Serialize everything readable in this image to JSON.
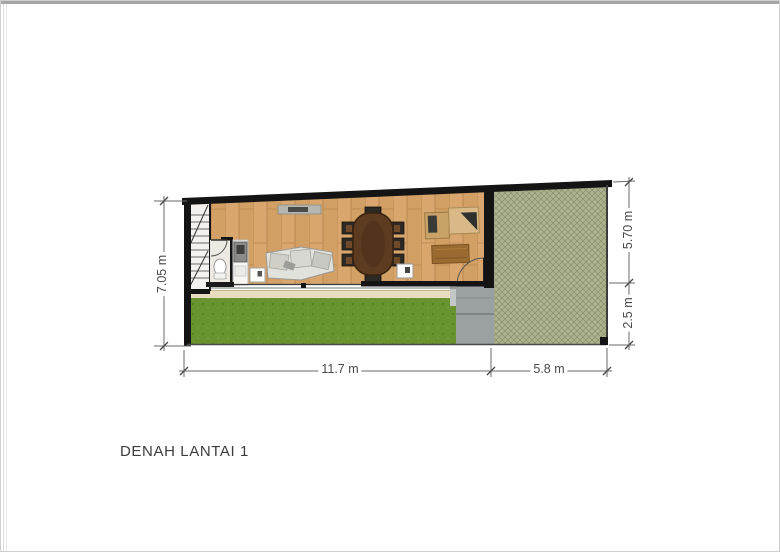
{
  "meta": {
    "title": "DENAH LANTAI 1"
  },
  "dimensions": {
    "left_height": "7.05 m",
    "right_upper": "5.70 m",
    "right_lower": "2.5 m",
    "bottom_main": "11.7 m",
    "bottom_side": "5.8 m"
  },
  "plan": {
    "features": [
      "staircase",
      "bathroom",
      "toilet",
      "kitchen-unit",
      "side-table",
      "tv-console",
      "sofa",
      "dining-table",
      "dining-chairs-8",
      "workstation-desk",
      "rug",
      "door-swing-backyard",
      "door-swing-bathroom",
      "glass-wall",
      "terrace",
      "lawn",
      "stepping-path",
      "paved-yard"
    ],
    "colors": {
      "wall": "#141414",
      "wood_floor": "#d9a76e",
      "lawn": "#68942f",
      "paved_yard": "#adb28f",
      "walkway": "#9ba1a3",
      "terrace": "#e9ddc1",
      "dimension_text": "#4a4a4a"
    }
  }
}
